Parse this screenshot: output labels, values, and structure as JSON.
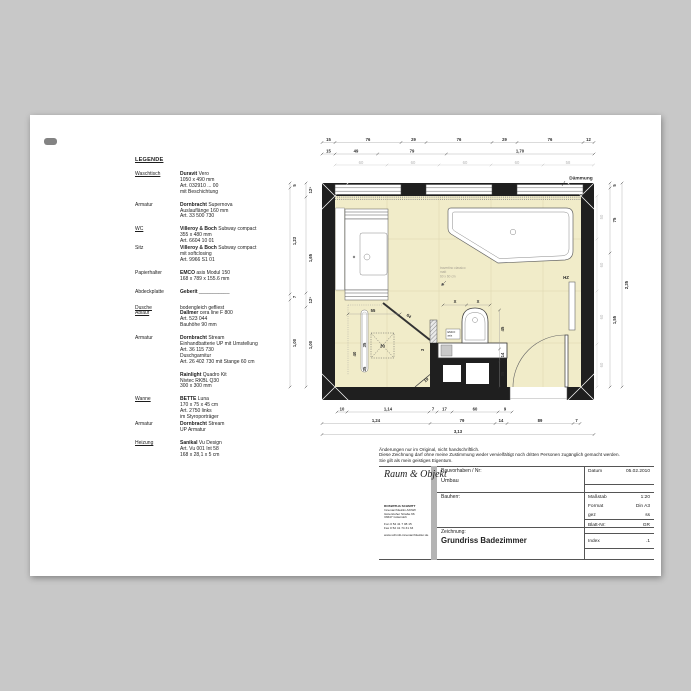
{
  "colors": {
    "canvas": "#c8c8c8",
    "paper": "#ffffff",
    "wall": "#1f1f1f",
    "floor": "#f1ecc9",
    "tile_grid": "#ddd6ae"
  },
  "legend": {
    "title": "LEGENDE",
    "items": [
      {
        "labels": [
          {
            "text": "Waschtisch",
            "u": true
          }
        ],
        "lines": [
          [
            {
              "b": true,
              "t": "Duravit"
            },
            {
              "b": false,
              "t": " Vero"
            }
          ],
          [
            {
              "b": false,
              "t": "1050 x 490 mm"
            }
          ],
          [
            {
              "b": false,
              "t": "Art. 032910 ... 00"
            }
          ],
          [
            {
              "b": false,
              "t": "mit Beschichtung"
            }
          ]
        ]
      },
      {
        "labels": [
          {
            "text": "Armatur",
            "u": false
          }
        ],
        "lines": [
          [
            {
              "b": true,
              "t": "Dornbracht"
            },
            {
              "b": false,
              "t": " Supernova"
            }
          ],
          [
            {
              "b": false,
              "t": "Auslauflänge 160 mm"
            }
          ],
          [
            {
              "b": false,
              "t": "Art. 33 500 730"
            }
          ]
        ]
      },
      {
        "labels": [
          {
            "text": "WC",
            "u": true
          }
        ],
        "lines": [
          [
            {
              "b": true,
              "t": "Villeroy & Boch"
            },
            {
              "b": false,
              "t": " Subway compact"
            }
          ],
          [
            {
              "b": false,
              "t": "355 x 480 mm"
            }
          ],
          [
            {
              "b": false,
              "t": "Art. 6604 10 01"
            }
          ]
        ]
      },
      {
        "labels": [
          {
            "text": "Sitz",
            "u": false
          }
        ],
        "lines": [
          [
            {
              "b": true,
              "t": "Villeroy & Boch"
            },
            {
              "b": false,
              "t": " Subway compact"
            }
          ],
          [
            {
              "b": false,
              "t": "mit softclosing"
            }
          ],
          [
            {
              "b": false,
              "t": "Art. 9966 S1 01"
            }
          ]
        ]
      },
      {
        "labels": [
          {
            "text": "Papierhalter",
            "u": false
          }
        ],
        "lines": [
          [
            {
              "b": true,
              "t": "EMCO"
            },
            {
              "b": false,
              "t": " asis Modul 150"
            }
          ],
          [
            {
              "b": false,
              "t": "168 x 789 x 155.6 mm"
            }
          ]
        ]
      },
      {
        "labels": [
          {
            "text": "Abdeckplatte",
            "u": false
          }
        ],
        "lines": [
          [
            {
              "b": true,
              "t": "Geberit"
            },
            {
              "b": false,
              "t": " ___________"
            }
          ]
        ]
      },
      {
        "labels": [
          {
            "text": "Dusche",
            "u": true
          },
          {
            "text": "Ablauf",
            "u": true
          }
        ],
        "lines": [
          [
            {
              "b": false,
              "t": "bodengleich gefliest"
            }
          ],
          [
            {
              "b": true,
              "t": "Dallmer"
            },
            {
              "b": false,
              "t": " cera line F 800"
            }
          ],
          [
            {
              "b": false,
              "t": "Art. 523 044"
            }
          ],
          [
            {
              "b": false,
              "t": "Bauhöhe 90 mm"
            }
          ]
        ]
      },
      {
        "labels": [
          {
            "text": "Armatur",
            "u": false
          }
        ],
        "lines": [
          [
            {
              "b": true,
              "t": "Dornbracht"
            },
            {
              "b": false,
              "t": " Stream"
            }
          ],
          [
            {
              "b": false,
              "t": "Einhandbatterie UP mit Umstellung"
            }
          ],
          [
            {
              "b": false,
              "t": "Art. 36 115 730"
            }
          ],
          [
            {
              "b": false,
              "t": "Duschgarnitur"
            }
          ],
          [
            {
              "b": false,
              "t": "Art. 26 402 730 mit Stange 60 cm"
            }
          ]
        ]
      },
      {
        "labels": [],
        "lines": [
          [
            {
              "b": true,
              "t": "Rainlight"
            },
            {
              "b": false,
              "t": " Quadro Kit"
            }
          ],
          [
            {
              "b": false,
              "t": "Nivtec RKBL Q30"
            }
          ],
          [
            {
              "b": false,
              "t": "300 x 300 mm"
            }
          ]
        ]
      },
      {
        "labels": [
          {
            "text": "Wanne",
            "u": true
          }
        ],
        "lines": [
          [
            {
              "b": true,
              "t": "BETTE"
            },
            {
              "b": false,
              "t": " Luna"
            }
          ],
          [
            {
              "b": false,
              "t": "170 x 75 x 45 cm"
            }
          ],
          [
            {
              "b": false,
              "t": "Art. 2750 links"
            }
          ],
          [
            {
              "b": false,
              "t": "im Styroporträger"
            }
          ]
        ]
      },
      {
        "labels": [
          {
            "text": "Armatur",
            "u": false
          }
        ],
        "lines": [
          [
            {
              "b": true,
              "t": "Dornbracht"
            },
            {
              "b": false,
              "t": " Stream"
            }
          ],
          [
            {
              "b": false,
              "t": "UP Armatur"
            }
          ]
        ]
      },
      {
        "labels": [
          {
            "text": "Heizung",
            "u": true
          }
        ],
        "lines": [
          [
            {
              "b": true,
              "t": "Sanikal"
            },
            {
              "b": false,
              "t": " Vu Design"
            }
          ],
          [
            {
              "b": false,
              "t": "Art. Vu 001 Int 58"
            }
          ],
          [
            {
              "b": false,
              "t": "168 x 28,1 x 5 cm"
            }
          ]
        ]
      }
    ]
  },
  "plan": {
    "labels": {
      "daemmung": "Dämmung",
      "hz": "HZ",
      "emco1": "EMCO",
      "emco2": "asis",
      "note1": "travertino classico",
      "note2": "matt",
      "note3": "60 x 60 cm"
    },
    "dims": {
      "top1": [
        "15",
        "76",
        "29",
        "76",
        "29",
        "76",
        "12"
      ],
      "top2": [
        "15",
        "49",
        "79",
        "1,70"
      ],
      "top3": [
        "60",
        "60",
        "60",
        "60",
        "58"
      ],
      "bottom1": [
        "10",
        "1,14",
        "7",
        "17",
        "60",
        "9"
      ],
      "bottom2": [
        "1,24",
        "79",
        "14",
        "89",
        "7"
      ],
      "bottom3": [
        "3,13"
      ],
      "left_outer": [
        "5",
        "1,23",
        "7",
        "1,00"
      ],
      "left_inner": [
        "12⁵",
        "1,65",
        "12⁵",
        "1,00"
      ],
      "right_tiles": [
        "50",
        "60",
        "60",
        "60"
      ],
      "right_outer": [
        "5",
        "75",
        "1,55"
      ],
      "right_total": [
        "2,35"
      ],
      "shower_width": "55",
      "diag": "64",
      "channel": "40",
      "head": "30",
      "head_top": "35",
      "head_bot": "35",
      "stub": "3",
      "diag2": "19",
      "x1": "X",
      "x2": "X",
      "wc1": "45",
      "wc2": "14",
      "wc3": "35"
    }
  },
  "titleblock": {
    "notice": [
      "Änderungen nur im Original, nicht handschriftlich.",
      "Diese Zeichnung darf ohne meine Zustimmung weder vervielfältigt noch dritten Personen zugänglich gemacht werden.",
      "Sie gilt als mein geistiges Eigentum."
    ],
    "logo": "Raum & Objekt",
    "address": [
      "ROSWITHA SCHMITT",
      "Innenarchitektin AKNW",
      "Gütersloher Straße 66",
      "33647 Gütersloh",
      "",
      "Fon 0 52 41 7 08 15",
      "Fax 0 52 41 74 31 33",
      "",
      "www.schmitt-innenarchitektur.de"
    ],
    "fields": {
      "bauvorhaben_label": "Bauvorhaben / Nr:",
      "bauvorhaben_value": "Umbau",
      "bauherr_label": "Bauherr:",
      "zeichnung_label": "Zeichnung:",
      "zeichnung_value": "Grundriss Badezimmer"
    },
    "meta": [
      {
        "label": "Datum",
        "value": "05.02.2010"
      },
      {
        "label": "Maßstab",
        "value": "1:20"
      },
      {
        "label": "Format",
        "value": "Din A3"
      },
      {
        "label": "gez",
        "value": "ss"
      },
      {
        "label": "Blatt-Nr:",
        "value": "GR"
      },
      {
        "label": "Index",
        "value": ".1"
      }
    ]
  }
}
